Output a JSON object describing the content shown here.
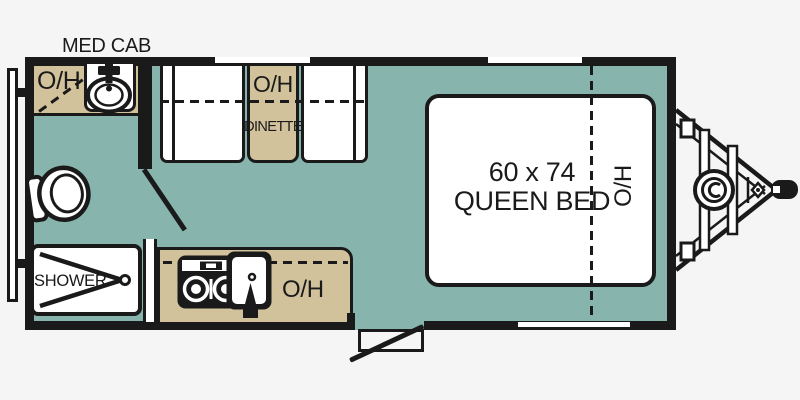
{
  "colors": {
    "floor": "#87b4ad",
    "cabinetry": "#d2c29c",
    "outline": "#1a1a1a",
    "fixture_fill": "#ffffff",
    "background": "#f5f5f6"
  },
  "labels": {
    "med_cab": "MED CAB",
    "bath_overhead": "O/H",
    "dinette_overhead": "O/H",
    "dinette": "DINETTE",
    "kitchen_overhead": "O/H",
    "shower": "SHOWER",
    "bed_size": "60 x 74",
    "bed_type": "QUEEN BED",
    "bed_overhead": "O/H"
  },
  "fixtures": [
    "rear-bumper",
    "bathroom-vanity-sink",
    "toilet",
    "shower-pan",
    "bathroom-door",
    "dinette-bench-left",
    "dinette-bench-right",
    "dinette-table",
    "kitchen-counter",
    "stove-cooktop",
    "kitchen-sink",
    "entry-door",
    "entry-step",
    "queen-bed",
    "window",
    "a-frame-tongue",
    "propane-tank",
    "hitch-coupler"
  ]
}
